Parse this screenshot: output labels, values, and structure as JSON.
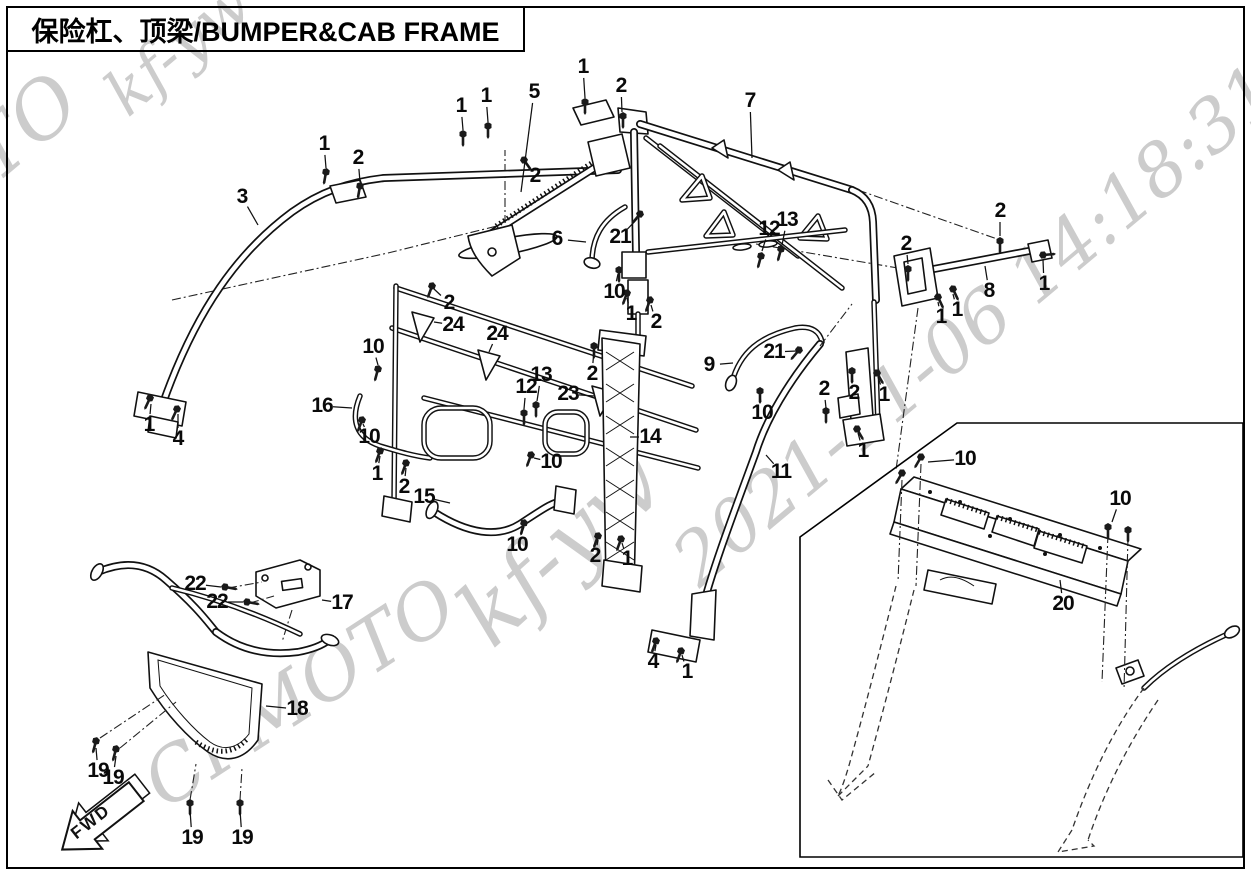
{
  "page": {
    "width": 1251,
    "height": 876
  },
  "style": {
    "background": "#ffffff",
    "line_color": "#111111",
    "watermark_color": "#cccccc"
  },
  "header": {
    "title": "保险杠、顶梁/BUMPER&CAB FRAME"
  },
  "fwd_marker": {
    "label": "FWD"
  },
  "watermarks": {
    "color": "#cccccc",
    "items": [
      {
        "text": "kf-yw",
        "x": 178,
        "y": 48,
        "size": 62,
        "angle": -40
      },
      {
        "text": "CFMOTO",
        "x": -75,
        "y": 210,
        "size": 78,
        "angle": -40
      },
      {
        "text": "2021-11-06 14:18:31",
        "x": 975,
        "y": 325,
        "size": 72,
        "angle": -40
      },
      {
        "text": "kf-yw",
        "x": 560,
        "y": 548,
        "size": 88,
        "angle": -42
      },
      {
        "text": "CFMOTO",
        "x": 300,
        "y": 693,
        "size": 74,
        "angle": -33
      }
    ]
  },
  "diagram": {
    "callouts": [
      {
        "n": "1",
        "x": 461,
        "y": 106,
        "lx": 463,
        "ly": 130
      },
      {
        "n": "1",
        "x": 486,
        "y": 96,
        "lx": 488,
        "ly": 122
      },
      {
        "n": "5",
        "x": 534,
        "y": 92,
        "lx": 521,
        "ly": 192
      },
      {
        "n": "1",
        "x": 583,
        "y": 67,
        "lx": 585,
        "ly": 98
      },
      {
        "n": "2",
        "x": 621,
        "y": 86,
        "lx": 622,
        "ly": 112
      },
      {
        "n": "2",
        "x": 535,
        "y": 176,
        "lx": 526,
        "ly": 163
      },
      {
        "n": "7",
        "x": 750,
        "y": 101,
        "lx": 752,
        "ly": 158
      },
      {
        "n": "3",
        "x": 242,
        "y": 197,
        "lx": 258,
        "ly": 225
      },
      {
        "n": "1",
        "x": 324,
        "y": 144,
        "lx": 326,
        "ly": 168
      },
      {
        "n": "2",
        "x": 358,
        "y": 158,
        "lx": 360,
        "ly": 182
      },
      {
        "n": "6",
        "x": 557,
        "y": 239,
        "lx": 586,
        "ly": 242
      },
      {
        "n": "21",
        "x": 620,
        "y": 237,
        "lx": 637,
        "ly": 219
      },
      {
        "n": "12",
        "x": 769,
        "y": 229,
        "lx": 762,
        "ly": 251
      },
      {
        "n": "13",
        "x": 787,
        "y": 220,
        "lx": 782,
        "ly": 245
      },
      {
        "n": "2",
        "x": 1000,
        "y": 211,
        "lx": 1000,
        "ly": 236
      },
      {
        "n": "2",
        "x": 906,
        "y": 244,
        "lx": 908,
        "ly": 264
      },
      {
        "n": "8",
        "x": 989,
        "y": 291,
        "lx": 985,
        "ly": 266
      },
      {
        "n": "1",
        "x": 1044,
        "y": 284,
        "lx": 1043,
        "ly": 260
      },
      {
        "n": "1",
        "x": 941,
        "y": 317,
        "lx": 938,
        "ly": 302
      },
      {
        "n": "1",
        "x": 957,
        "y": 310,
        "lx": 953,
        "ly": 294
      },
      {
        "n": "10",
        "x": 614,
        "y": 292,
        "lx": 618,
        "ly": 274
      },
      {
        "n": "1",
        "x": 631,
        "y": 314,
        "lx": 627,
        "ly": 298
      },
      {
        "n": "2",
        "x": 656,
        "y": 322,
        "lx": 651,
        "ly": 305
      },
      {
        "n": "2",
        "x": 449,
        "y": 303,
        "lx": 434,
        "ly": 289
      },
      {
        "n": "24",
        "x": 453,
        "y": 325,
        "lx": 434,
        "ly": 322
      },
      {
        "n": "24",
        "x": 497,
        "y": 334,
        "lx": 489,
        "ly": 352
      },
      {
        "n": "10",
        "x": 373,
        "y": 347,
        "lx": 378,
        "ly": 365
      },
      {
        "n": "16",
        "x": 322,
        "y": 406,
        "lx": 352,
        "ly": 408
      },
      {
        "n": "1",
        "x": 149,
        "y": 425,
        "lx": 151,
        "ly": 404
      },
      {
        "n": "4",
        "x": 178,
        "y": 439,
        "lx": 178,
        "ly": 414
      },
      {
        "n": "10",
        "x": 369,
        "y": 437,
        "lx": 363,
        "ly": 424
      },
      {
        "n": "1",
        "x": 377,
        "y": 474,
        "lx": 380,
        "ly": 456
      },
      {
        "n": "2",
        "x": 404,
        "y": 487,
        "lx": 406,
        "ly": 468
      },
      {
        "n": "15",
        "x": 424,
        "y": 497,
        "lx": 450,
        "ly": 503
      },
      {
        "n": "10",
        "x": 551,
        "y": 462,
        "lx": 534,
        "ly": 458
      },
      {
        "n": "10",
        "x": 517,
        "y": 545,
        "lx": 524,
        "ly": 527
      },
      {
        "n": "12",
        "x": 526,
        "y": 387,
        "lx": 524,
        "ly": 409
      },
      {
        "n": "13",
        "x": 541,
        "y": 375,
        "lx": 537,
        "ly": 401
      },
      {
        "n": "23",
        "x": 568,
        "y": 394,
        "lx": 594,
        "ly": 396
      },
      {
        "n": "2",
        "x": 592,
        "y": 374,
        "lx": 594,
        "ly": 350
      },
      {
        "n": "14",
        "x": 650,
        "y": 437,
        "lx": 630,
        "ly": 437
      },
      {
        "n": "9",
        "x": 709,
        "y": 365,
        "lx": 733,
        "ly": 363
      },
      {
        "n": "21",
        "x": 774,
        "y": 352,
        "lx": 797,
        "ly": 351
      },
      {
        "n": "10",
        "x": 762,
        "y": 413,
        "lx": 760,
        "ly": 395
      },
      {
        "n": "2",
        "x": 824,
        "y": 389,
        "lx": 826,
        "ly": 408
      },
      {
        "n": "2",
        "x": 854,
        "y": 393,
        "lx": 852,
        "ly": 375
      },
      {
        "n": "1",
        "x": 884,
        "y": 395,
        "lx": 878,
        "ly": 377
      },
      {
        "n": "1",
        "x": 863,
        "y": 451,
        "lx": 858,
        "ly": 433
      },
      {
        "n": "11",
        "x": 781,
        "y": 472,
        "lx": 766,
        "ly": 455
      },
      {
        "n": "2",
        "x": 595,
        "y": 556,
        "lx": 598,
        "ly": 540
      },
      {
        "n": "1",
        "x": 627,
        "y": 559,
        "lx": 622,
        "ly": 543
      },
      {
        "n": "4",
        "x": 653,
        "y": 662,
        "lx": 656,
        "ly": 645
      },
      {
        "n": "1",
        "x": 687,
        "y": 672,
        "lx": 682,
        "ly": 655
      },
      {
        "n": "22",
        "x": 195,
        "y": 584,
        "lx": 221,
        "ly": 587
      },
      {
        "n": "22",
        "x": 217,
        "y": 602,
        "lx": 243,
        "ly": 602
      },
      {
        "n": "17",
        "x": 342,
        "y": 603,
        "lx": 322,
        "ly": 600
      },
      {
        "n": "18",
        "x": 297,
        "y": 709,
        "lx": 266,
        "ly": 706
      },
      {
        "n": "19",
        "x": 98,
        "y": 771,
        "lx": 96,
        "ly": 748
      },
      {
        "n": "19",
        "x": 113,
        "y": 778,
        "lx": 116,
        "ly": 756
      },
      {
        "n": "19",
        "x": 192,
        "y": 838,
        "lx": 190,
        "ly": 810
      },
      {
        "n": "19",
        "x": 242,
        "y": 838,
        "lx": 240,
        "ly": 810
      },
      {
        "n": "10",
        "x": 965,
        "y": 459,
        "lx": 928,
        "ly": 462
      },
      {
        "n": "10",
        "x": 1120,
        "y": 499,
        "lx": 1112,
        "ly": 522
      },
      {
        "n": "20",
        "x": 1063,
        "y": 604,
        "lx": 1060,
        "ly": 580
      }
    ]
  }
}
